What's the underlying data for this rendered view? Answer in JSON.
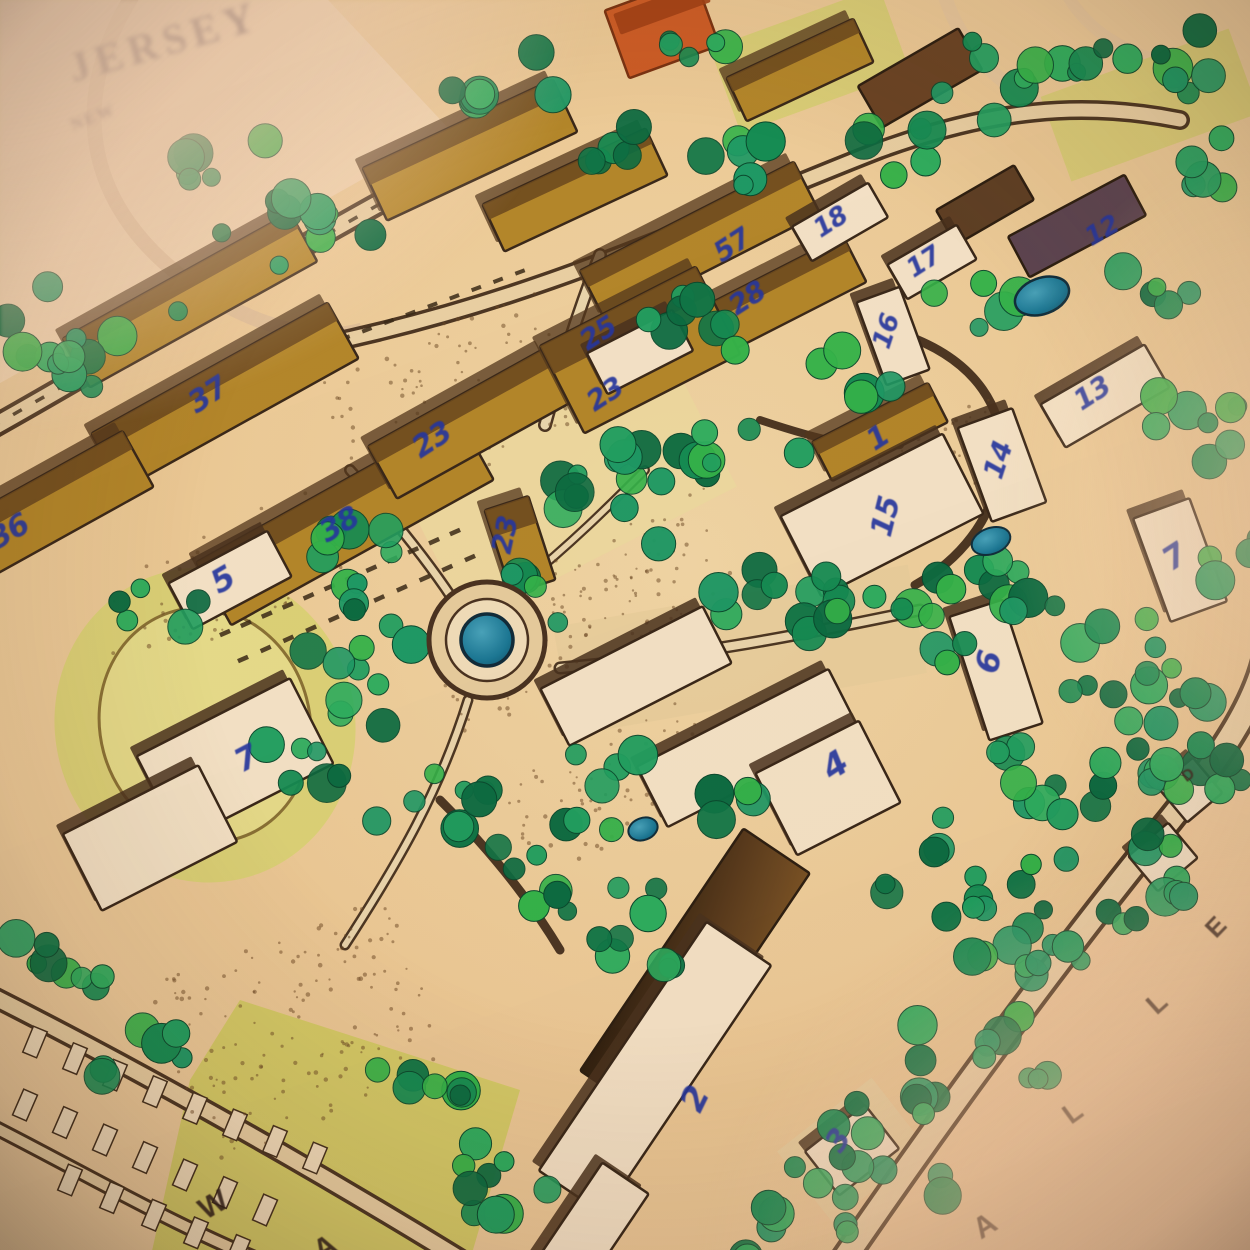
{
  "header": {
    "line1": "NEW",
    "line2": "JERSEY"
  },
  "buildings": [
    {
      "number": "37"
    },
    {
      "number": "23"
    },
    {
      "number": "38"
    },
    {
      "number": "36"
    },
    {
      "number": "5"
    },
    {
      "number": "7"
    },
    {
      "number": "23"
    },
    {
      "number": "25"
    },
    {
      "number": "23"
    },
    {
      "number": "57"
    },
    {
      "number": "28"
    },
    {
      "number": "18"
    },
    {
      "number": "17"
    },
    {
      "number": "16"
    },
    {
      "number": "12"
    },
    {
      "number": "13"
    },
    {
      "number": "14"
    },
    {
      "number": "15"
    },
    {
      "number": "1"
    },
    {
      "number": "7"
    },
    {
      "number": "6"
    },
    {
      "number": "4"
    },
    {
      "number": "2"
    },
    {
      "number": "3"
    }
  ],
  "streets": {
    "right": [
      "A",
      "L",
      "L",
      "E"
    ],
    "right_marker": "D",
    "bottom": [
      "W",
      "A"
    ]
  },
  "colors": {
    "ink_blue": "#2637a8",
    "road_brown": "#4d3824",
    "building_gold": "#b48a2c",
    "building_white": "#f4e9d2",
    "tree_green": "#22a566",
    "tree_dark": "#0d6f45",
    "lawn": "#d8d47a",
    "water": "#1b7a9c",
    "paper": "#eed6ae",
    "accent_orange": "#cd5f28"
  }
}
